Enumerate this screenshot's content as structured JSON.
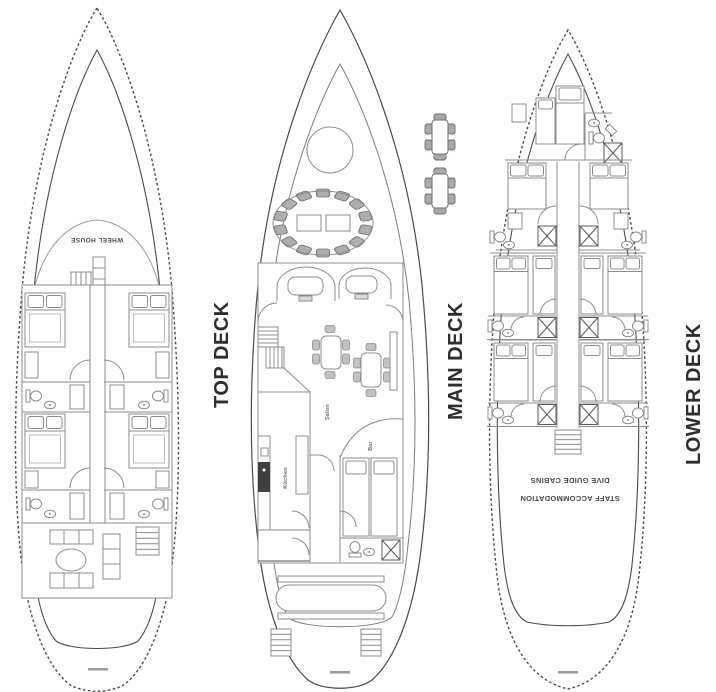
{
  "page": {
    "background": "#ffffff"
  },
  "decks": {
    "top": {
      "label": "TOP DECK"
    },
    "main": {
      "label": "MAIN DECK"
    },
    "lower": {
      "label": "LOWER DECK"
    }
  },
  "annotations": {
    "wheel_house": "WHEEL HOUSE",
    "kitchen": "Kitchen",
    "salon": "Salon",
    "bar": "Bar",
    "staff_accommodation": "STAFF ACCOMMODATION",
    "dive_guide_cabins": "DIVE GUIDE CABINS"
  },
  "colors": {
    "hull_line": "#4a4a4a",
    "interior_line": "#8c8c8c",
    "label_text": "#2e2e2e",
    "chair_fill": "#aeaeae",
    "stove_fill": "#3f3f3f"
  }
}
